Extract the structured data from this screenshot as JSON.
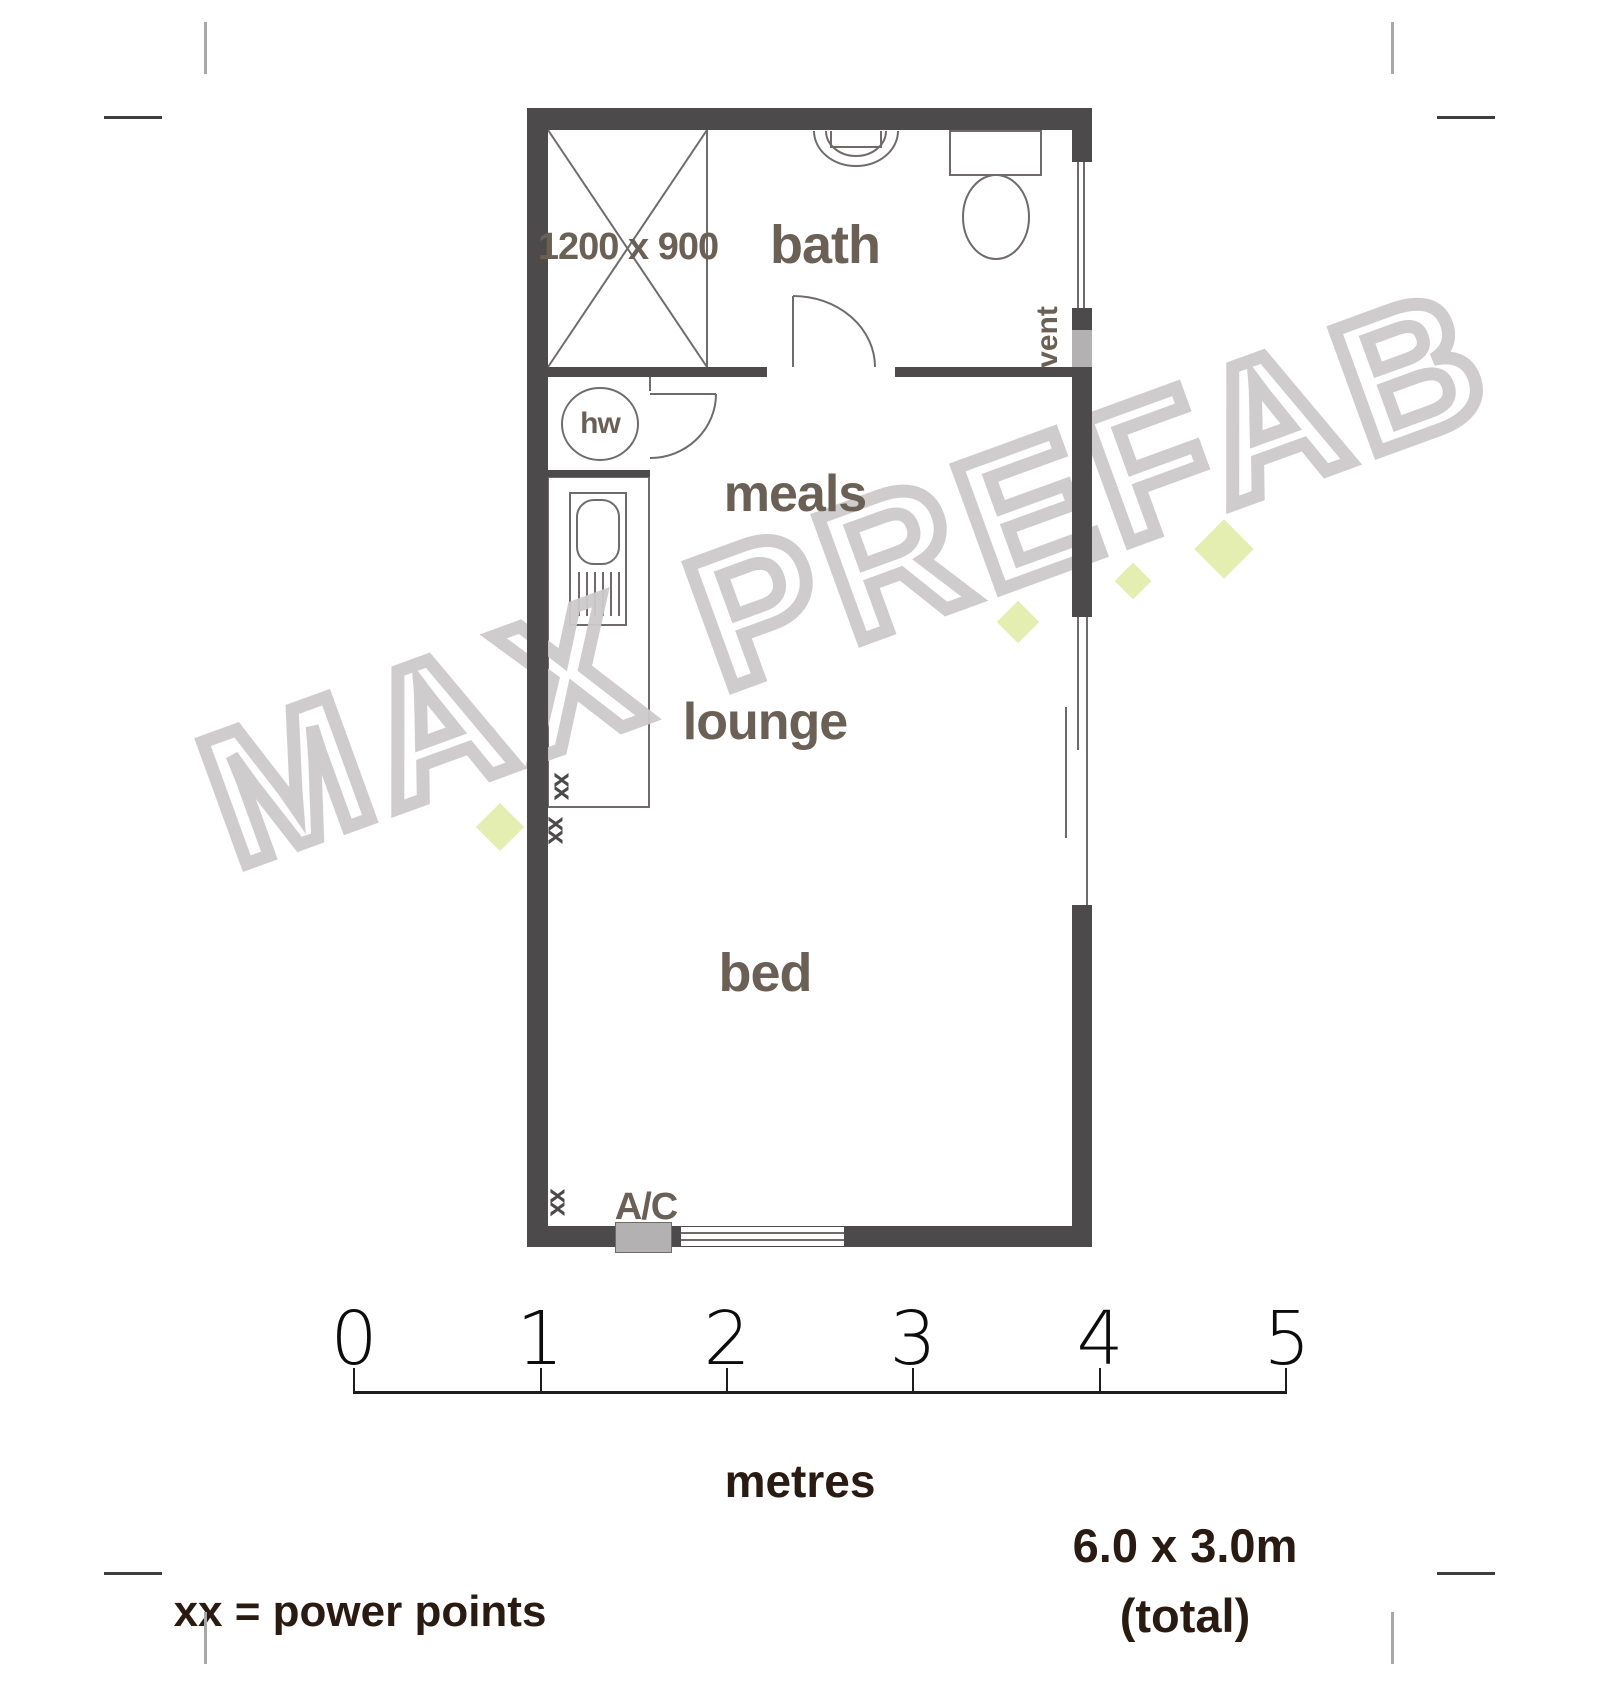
{
  "watermark": {
    "text": "MAX PREFAB",
    "stroke_color": "#cdcacb",
    "accent_color": "#e4eeb0"
  },
  "plan": {
    "wall_color": "#4c4a4b",
    "label_color": "#6b6056",
    "rooms": {
      "bath": "bath",
      "meals": "meals",
      "lounge": "lounge",
      "bed": "bed"
    },
    "shower_dim": "1200 x 900",
    "hot_water_label": "hw",
    "vent_label": "vent",
    "ac_label": "A/C",
    "power_point_symbol": "xx"
  },
  "scale": {
    "tick_labels": [
      "0",
      "1",
      "2",
      "3",
      "4",
      "5"
    ],
    "unit_label": "metres"
  },
  "legend": {
    "power_points": "xx = power points"
  },
  "dimensions": {
    "size": "6.0 x 3.0m",
    "qualifier": "(total)"
  }
}
